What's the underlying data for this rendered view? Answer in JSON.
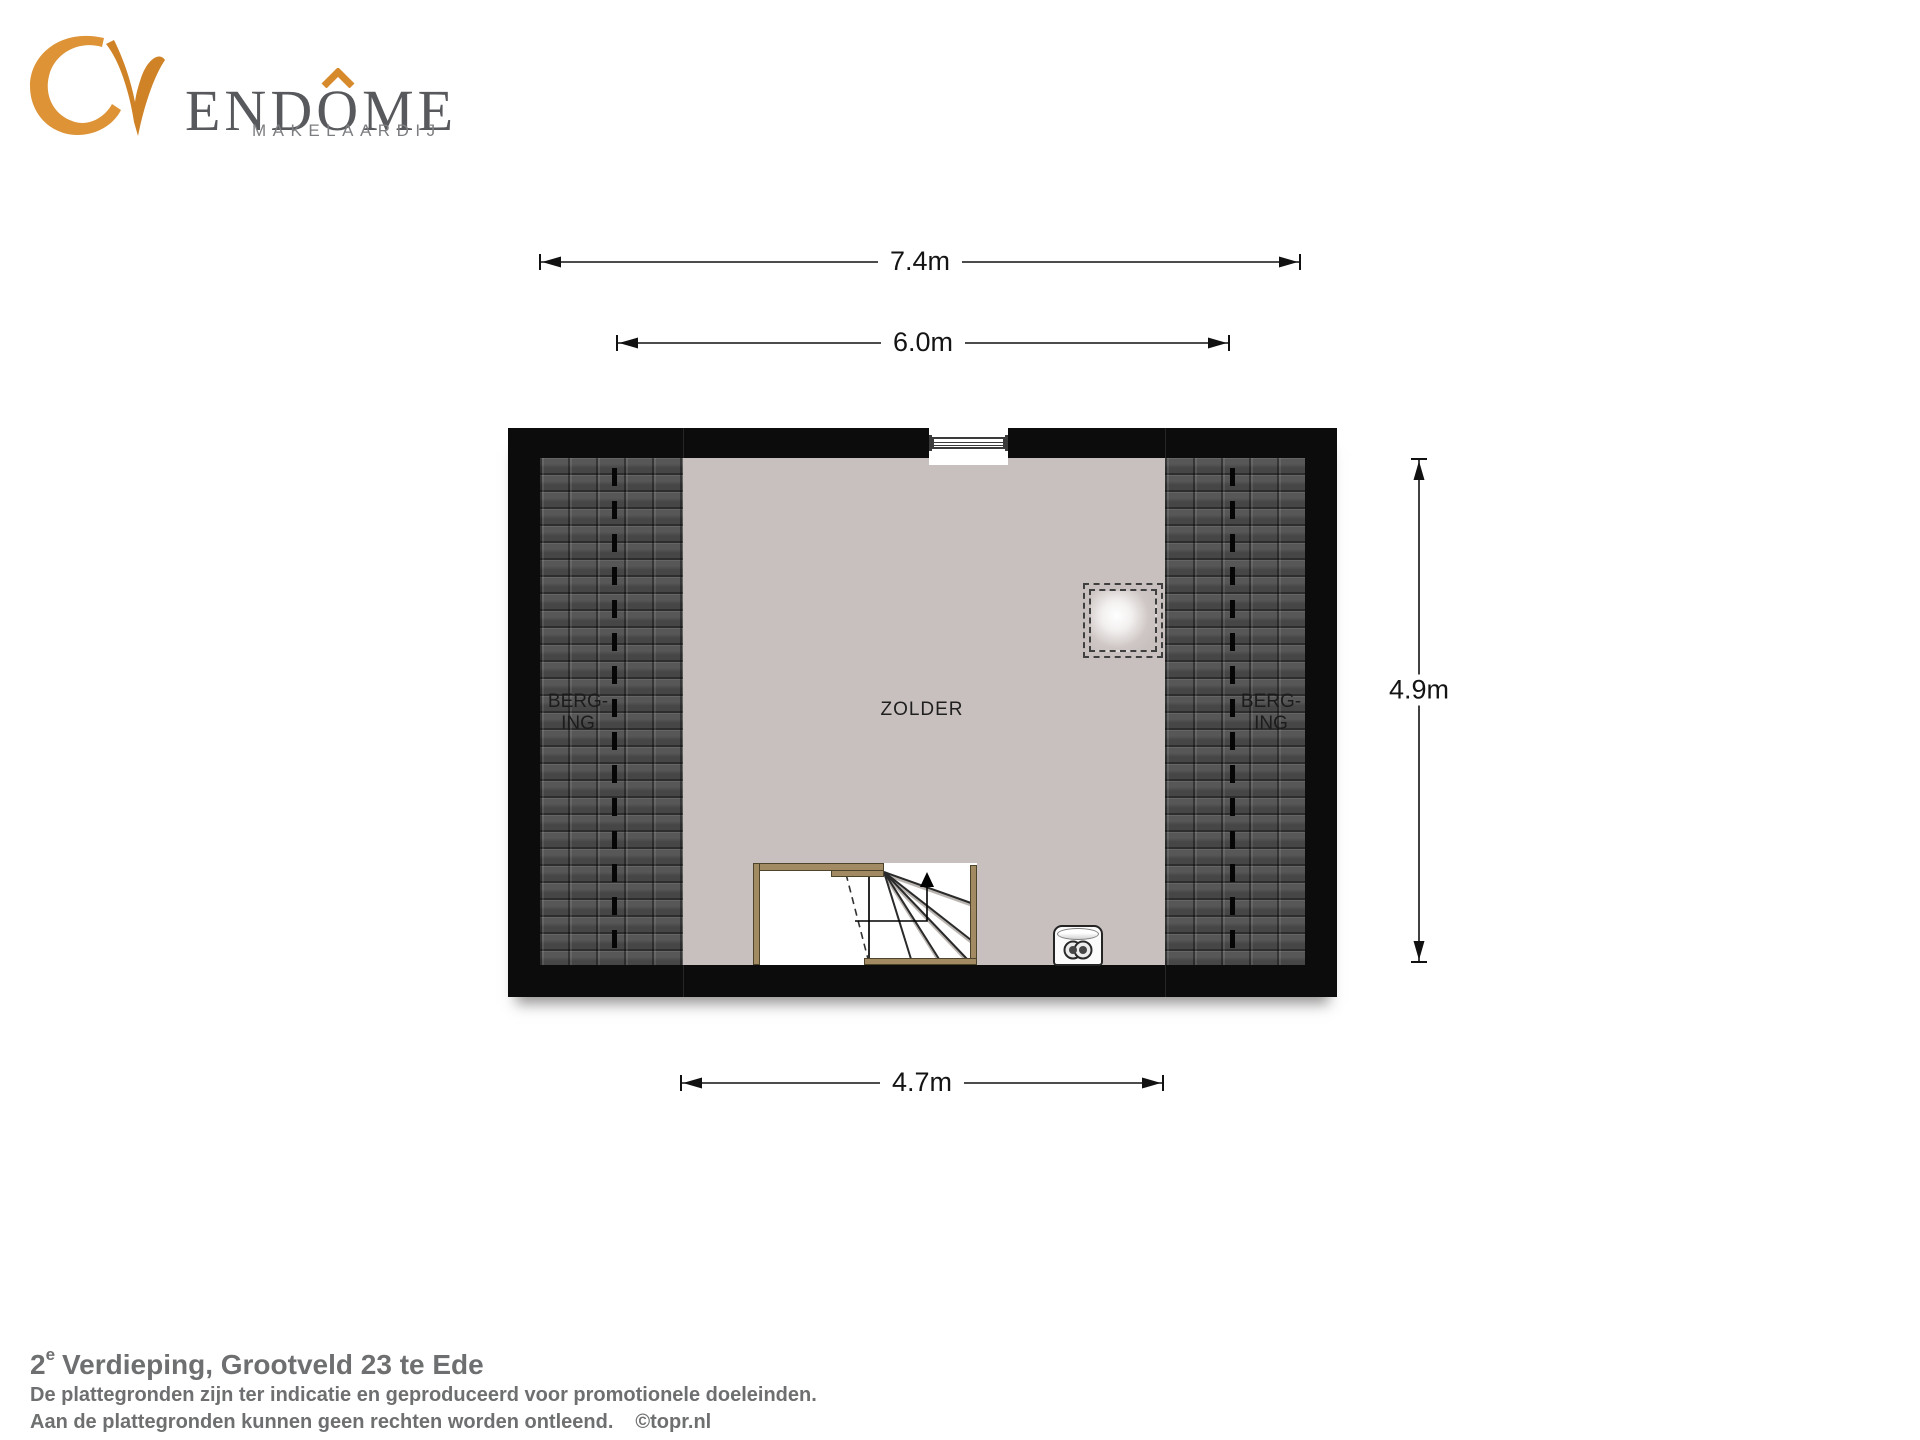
{
  "logo": {
    "wordmark_pre": "END",
    "wordmark_o": "O",
    "wordmark_post": "ME",
    "subtitle": "MAKELAARDIJ",
    "accent_color": "#d78a2c",
    "wordmark_color": "#58595c"
  },
  "dimensions": {
    "outer_width": "7.4m",
    "inner_width": "6.0m",
    "floor_width": "4.7m",
    "height": "4.9m"
  },
  "plan": {
    "room_label": "ZOLDER",
    "storage_left": [
      "BERG-",
      "ING"
    ],
    "storage_right": [
      "BERG-",
      "ING"
    ],
    "colors": {
      "wall": "#0c0c0c",
      "floor": "#c8c0be",
      "roof_tiles": "#4e4e4e",
      "stair_wood": "#a28a62"
    }
  },
  "footer": {
    "title_number": "2",
    "title_sup": "e",
    "title_rest": "Verdieping, Grootveld 23 te Ede",
    "note_line1": "De plattegronden zijn ter indicatie en geproduceerd voor promotionele doeleinden.",
    "note_line2": "Aan de plattegronden kunnen geen rechten worden ontleend.",
    "credit": "©topr.nl"
  }
}
